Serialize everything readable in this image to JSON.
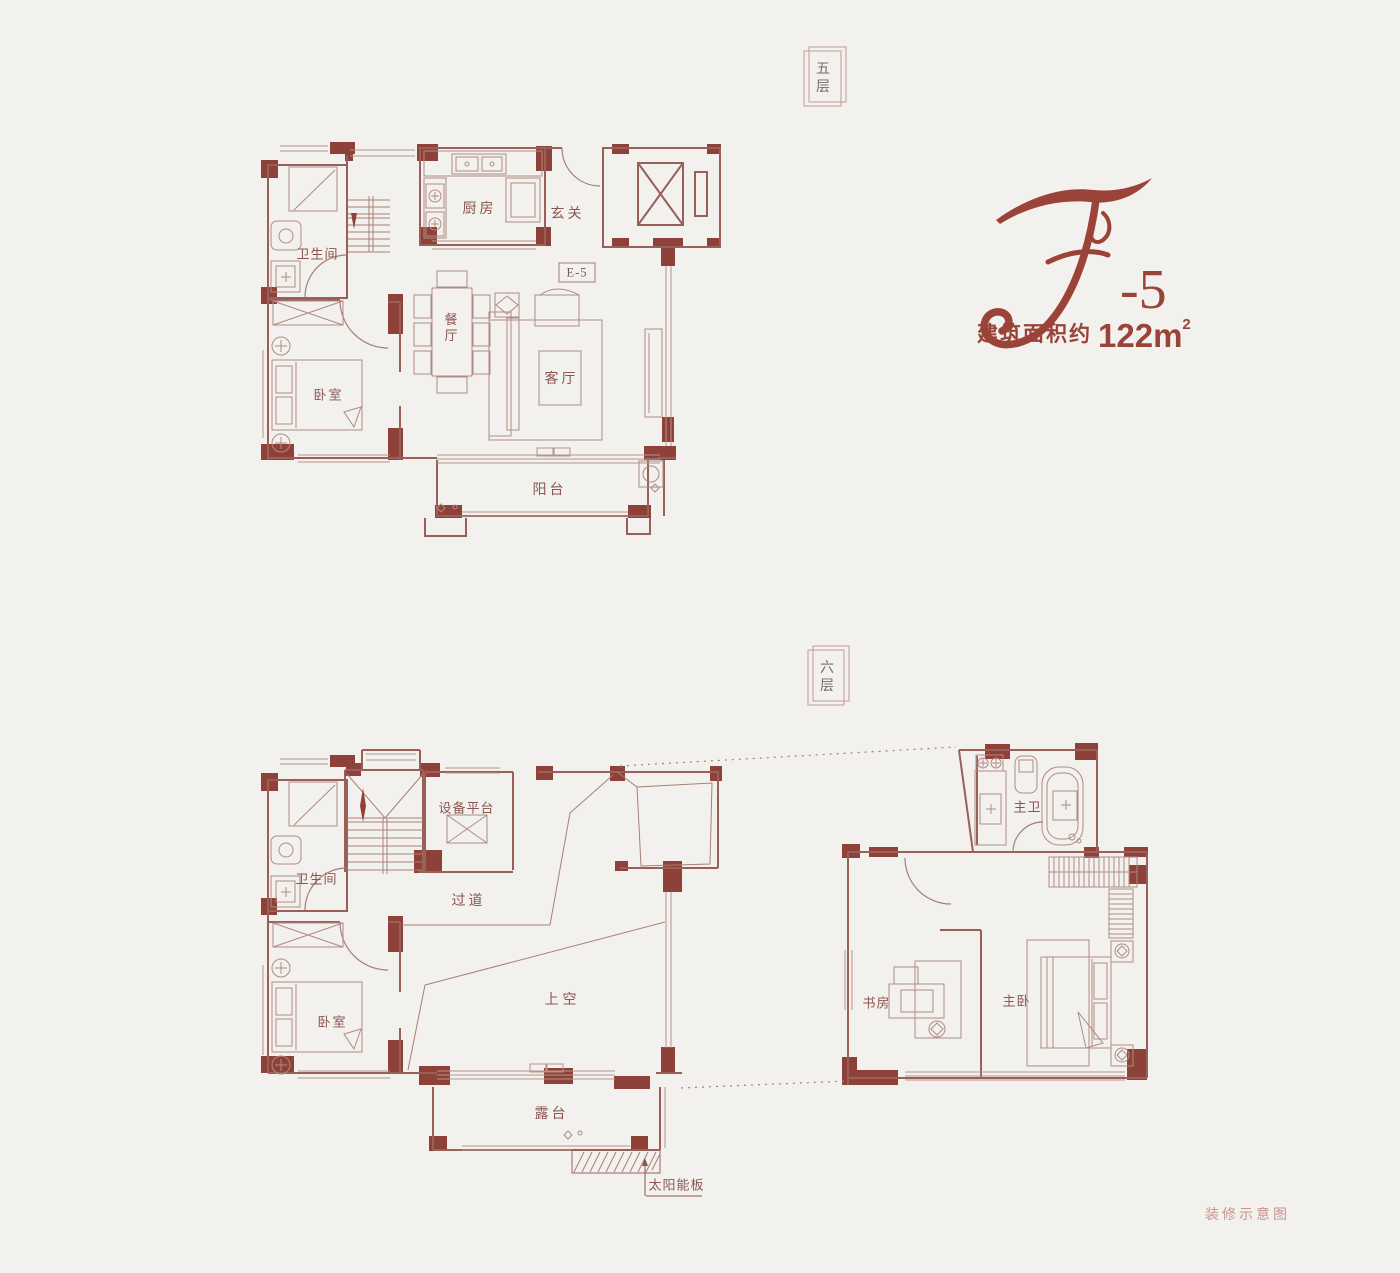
{
  "meta": {
    "doc_label": "装修示意图"
  },
  "unit": {
    "script_letter": "E",
    "suffix": "-5",
    "area_prefix": "建筑面积约",
    "area_number": "122",
    "area_unit": "m",
    "area_sup": "2"
  },
  "floors": {
    "f5": {
      "tag": "五层",
      "code": "E-5",
      "rooms": {
        "bath": "卫生间",
        "kitchen": "厨房",
        "foyer": "玄关",
        "dining": "餐厅",
        "living": "客厅",
        "bedroom": "卧室",
        "balcony": "阳台"
      }
    },
    "f6": {
      "tag": "六层",
      "rooms": {
        "bath": "卫生间",
        "equipment": "设备平台",
        "corridor": "过道",
        "bedroom": "卧室",
        "void": "上空",
        "terrace": "露台",
        "solar": "太阳能板",
        "master_bath": "主卫",
        "study": "书房",
        "master_bed": "主卧"
      }
    }
  },
  "colors": {
    "background": "#f2f1ee",
    "wall_fill": "#8d4138",
    "wall_line": "#99605a",
    "accent": "#9a4338",
    "room_text": "#8a564e",
    "tag_text": "#7b6c68",
    "faint_text": "#c9948e"
  }
}
